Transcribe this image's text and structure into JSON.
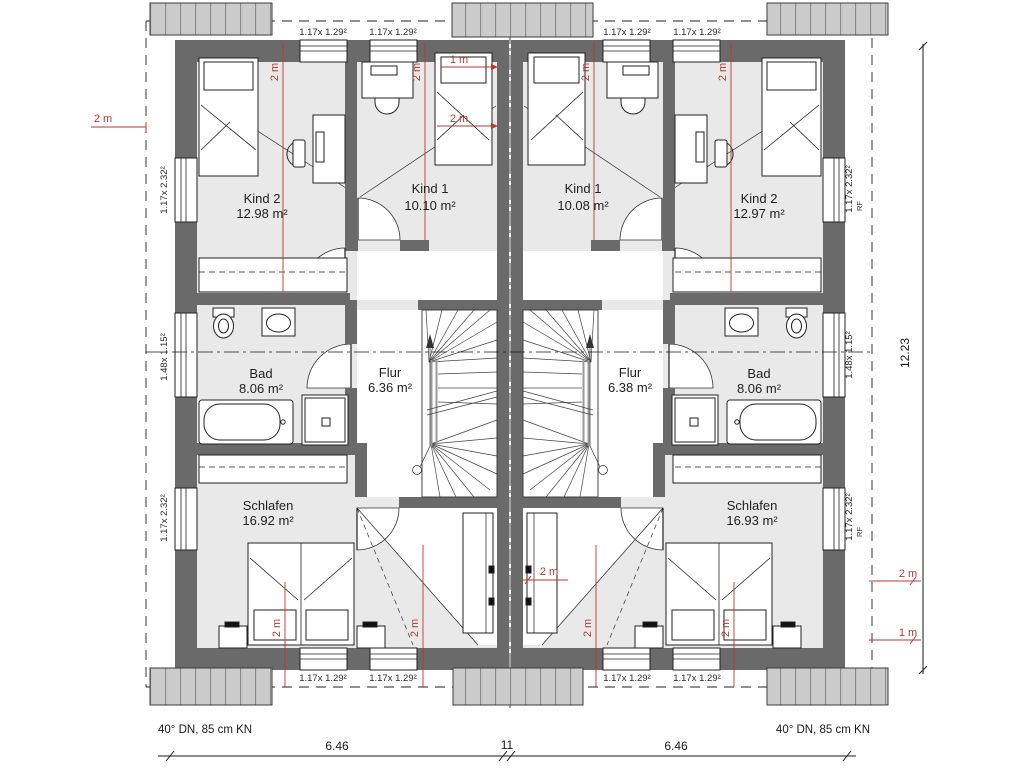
{
  "floorplan": {
    "units": {
      "left": {
        "rooms": [
          {
            "name": "Kind 2",
            "area": "12.98 m²"
          },
          {
            "name": "Kind 1",
            "area": "10.10 m²"
          },
          {
            "name": "Bad",
            "area": "8.06 m²"
          },
          {
            "name": "Flur",
            "area": "6.36 m²"
          },
          {
            "name": "Schlafen",
            "area": "16.92 m²"
          }
        ]
      },
      "right": {
        "rooms": [
          {
            "name": "Kind 1",
            "area": "10.08 m²"
          },
          {
            "name": "Kind 2",
            "area": "12.97 m²"
          },
          {
            "name": "Flur",
            "area": "6.38 m²"
          },
          {
            "name": "Bad",
            "area": "8.06 m²"
          },
          {
            "name": "Schlafen",
            "area": "16.93 m²"
          }
        ]
      }
    },
    "window_labels": {
      "top": [
        "1.17x 1.29²",
        "1.17x 1.29²",
        "1.17x 1.29²",
        "1.17x 1.29²"
      ],
      "bottom": [
        "1.17x 1.29²",
        "1.17x 1.29²",
        "1.17x 1.29²",
        "1.17x 1.29²"
      ],
      "left_side": [
        "1.17x 2.32²",
        "1.48x 1.15²",
        "1.17x 2.32²"
      ],
      "right_side": [
        "1.17x 2.32²",
        "1.48x 1.15²",
        "1.17x 2.32²"
      ],
      "rf_mark": "RF"
    },
    "red_markers": {
      "two_m": "2 m",
      "one_m": "1 m"
    },
    "dimensions": {
      "total_height": "12.23",
      "left_width": "6.46",
      "party_gap": "11",
      "right_width": "6.46"
    },
    "roof_notes": {
      "left": "40° DN, 85 cm KN",
      "right": "40° DN, 85 cm KN"
    },
    "colors": {
      "wall": "#6a6a6a",
      "room_fill": "#e9e9e9",
      "accent_red": "#b53a32",
      "block_fill": "#cbcbcb"
    }
  }
}
